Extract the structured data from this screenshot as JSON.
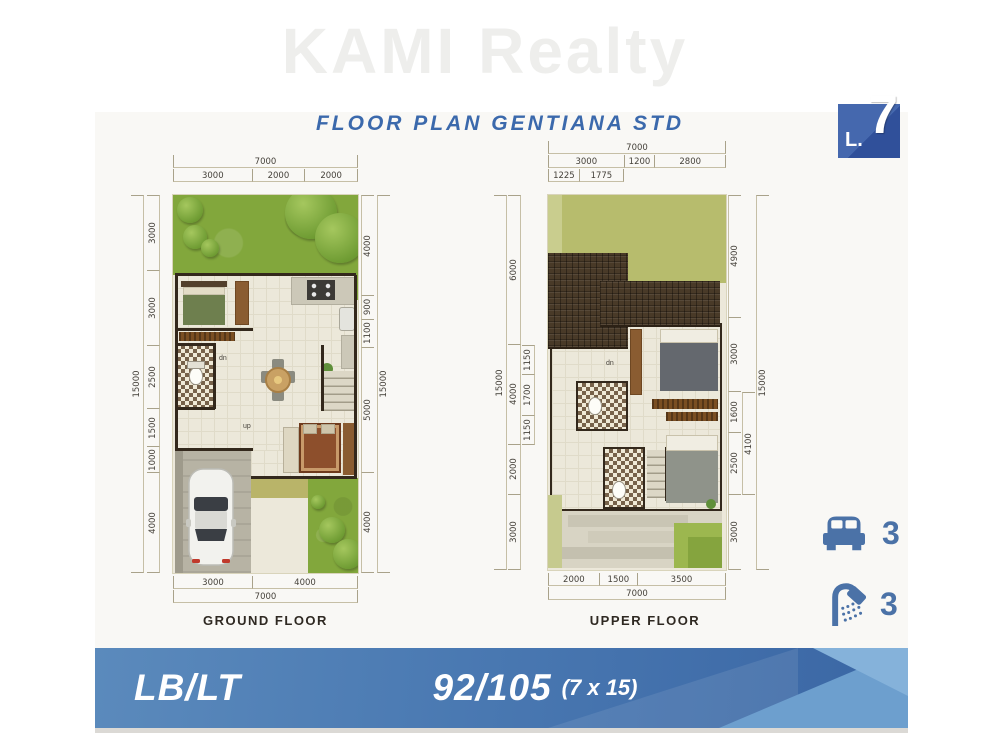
{
  "watermark": "KAMI Realty",
  "title": "FLOOR PLAN GENTIANA STD",
  "badge": {
    "prefix": "L.",
    "number": "7"
  },
  "colors": {
    "accent-blue": "#3b69ac",
    "banner-blue": "#4a79b2",
    "banner-blue-dark": "#3a66a4",
    "banner-blue-light": "#79aad6",
    "badge-blue": "#3c5fa6",
    "icon-blue": "#4b72a7",
    "garden-green": "#82a73c",
    "olive-green": "#b7bc6d",
    "roof-brown": "#493a28",
    "wall-dark": "#33281c",
    "floor-beige": "#ece8da"
  },
  "ground_floor": {
    "label": "GROUND FLOOR",
    "dims": {
      "top_total": [
        7000
      ],
      "top": [
        3000,
        2000,
        2000
      ],
      "left_total": [
        15000
      ],
      "left": [
        3000,
        3000,
        2500,
        1500,
        1000,
        4000
      ],
      "right": [
        4000,
        900,
        1100,
        5000,
        4000
      ],
      "right_total": [
        15000
      ],
      "bottom": [
        3000,
        4000
      ],
      "bottom_total": [
        7000
      ]
    },
    "annotations": {
      "dn": "dn",
      "up": "up"
    }
  },
  "upper_floor": {
    "label": "UPPER FLOOR",
    "dims": {
      "top_total": [
        7000
      ],
      "top": [
        3000,
        1200,
        2800
      ],
      "top_inner": [
        1225,
        1775
      ],
      "left_total": [
        15000
      ],
      "left": [
        6000,
        4000,
        2000,
        3000
      ],
      "left_inner": [
        1150,
        1700,
        1150
      ],
      "right": [
        4900,
        3000,
        1600,
        2500,
        3000
      ],
      "right_mid": [
        4100
      ],
      "right_total": [
        15000
      ],
      "bottom": [
        2000,
        1500,
        3500
      ],
      "bottom_total": [
        7000
      ]
    },
    "annotations": {
      "dn": "dn"
    }
  },
  "features": {
    "bedrooms": {
      "icon": "bed-icon",
      "count": "3"
    },
    "bathrooms": {
      "icon": "shower-icon",
      "count": "3"
    }
  },
  "footer": {
    "left": "LB/LT",
    "value": "92/105",
    "size_note": "(7 x 15)"
  }
}
